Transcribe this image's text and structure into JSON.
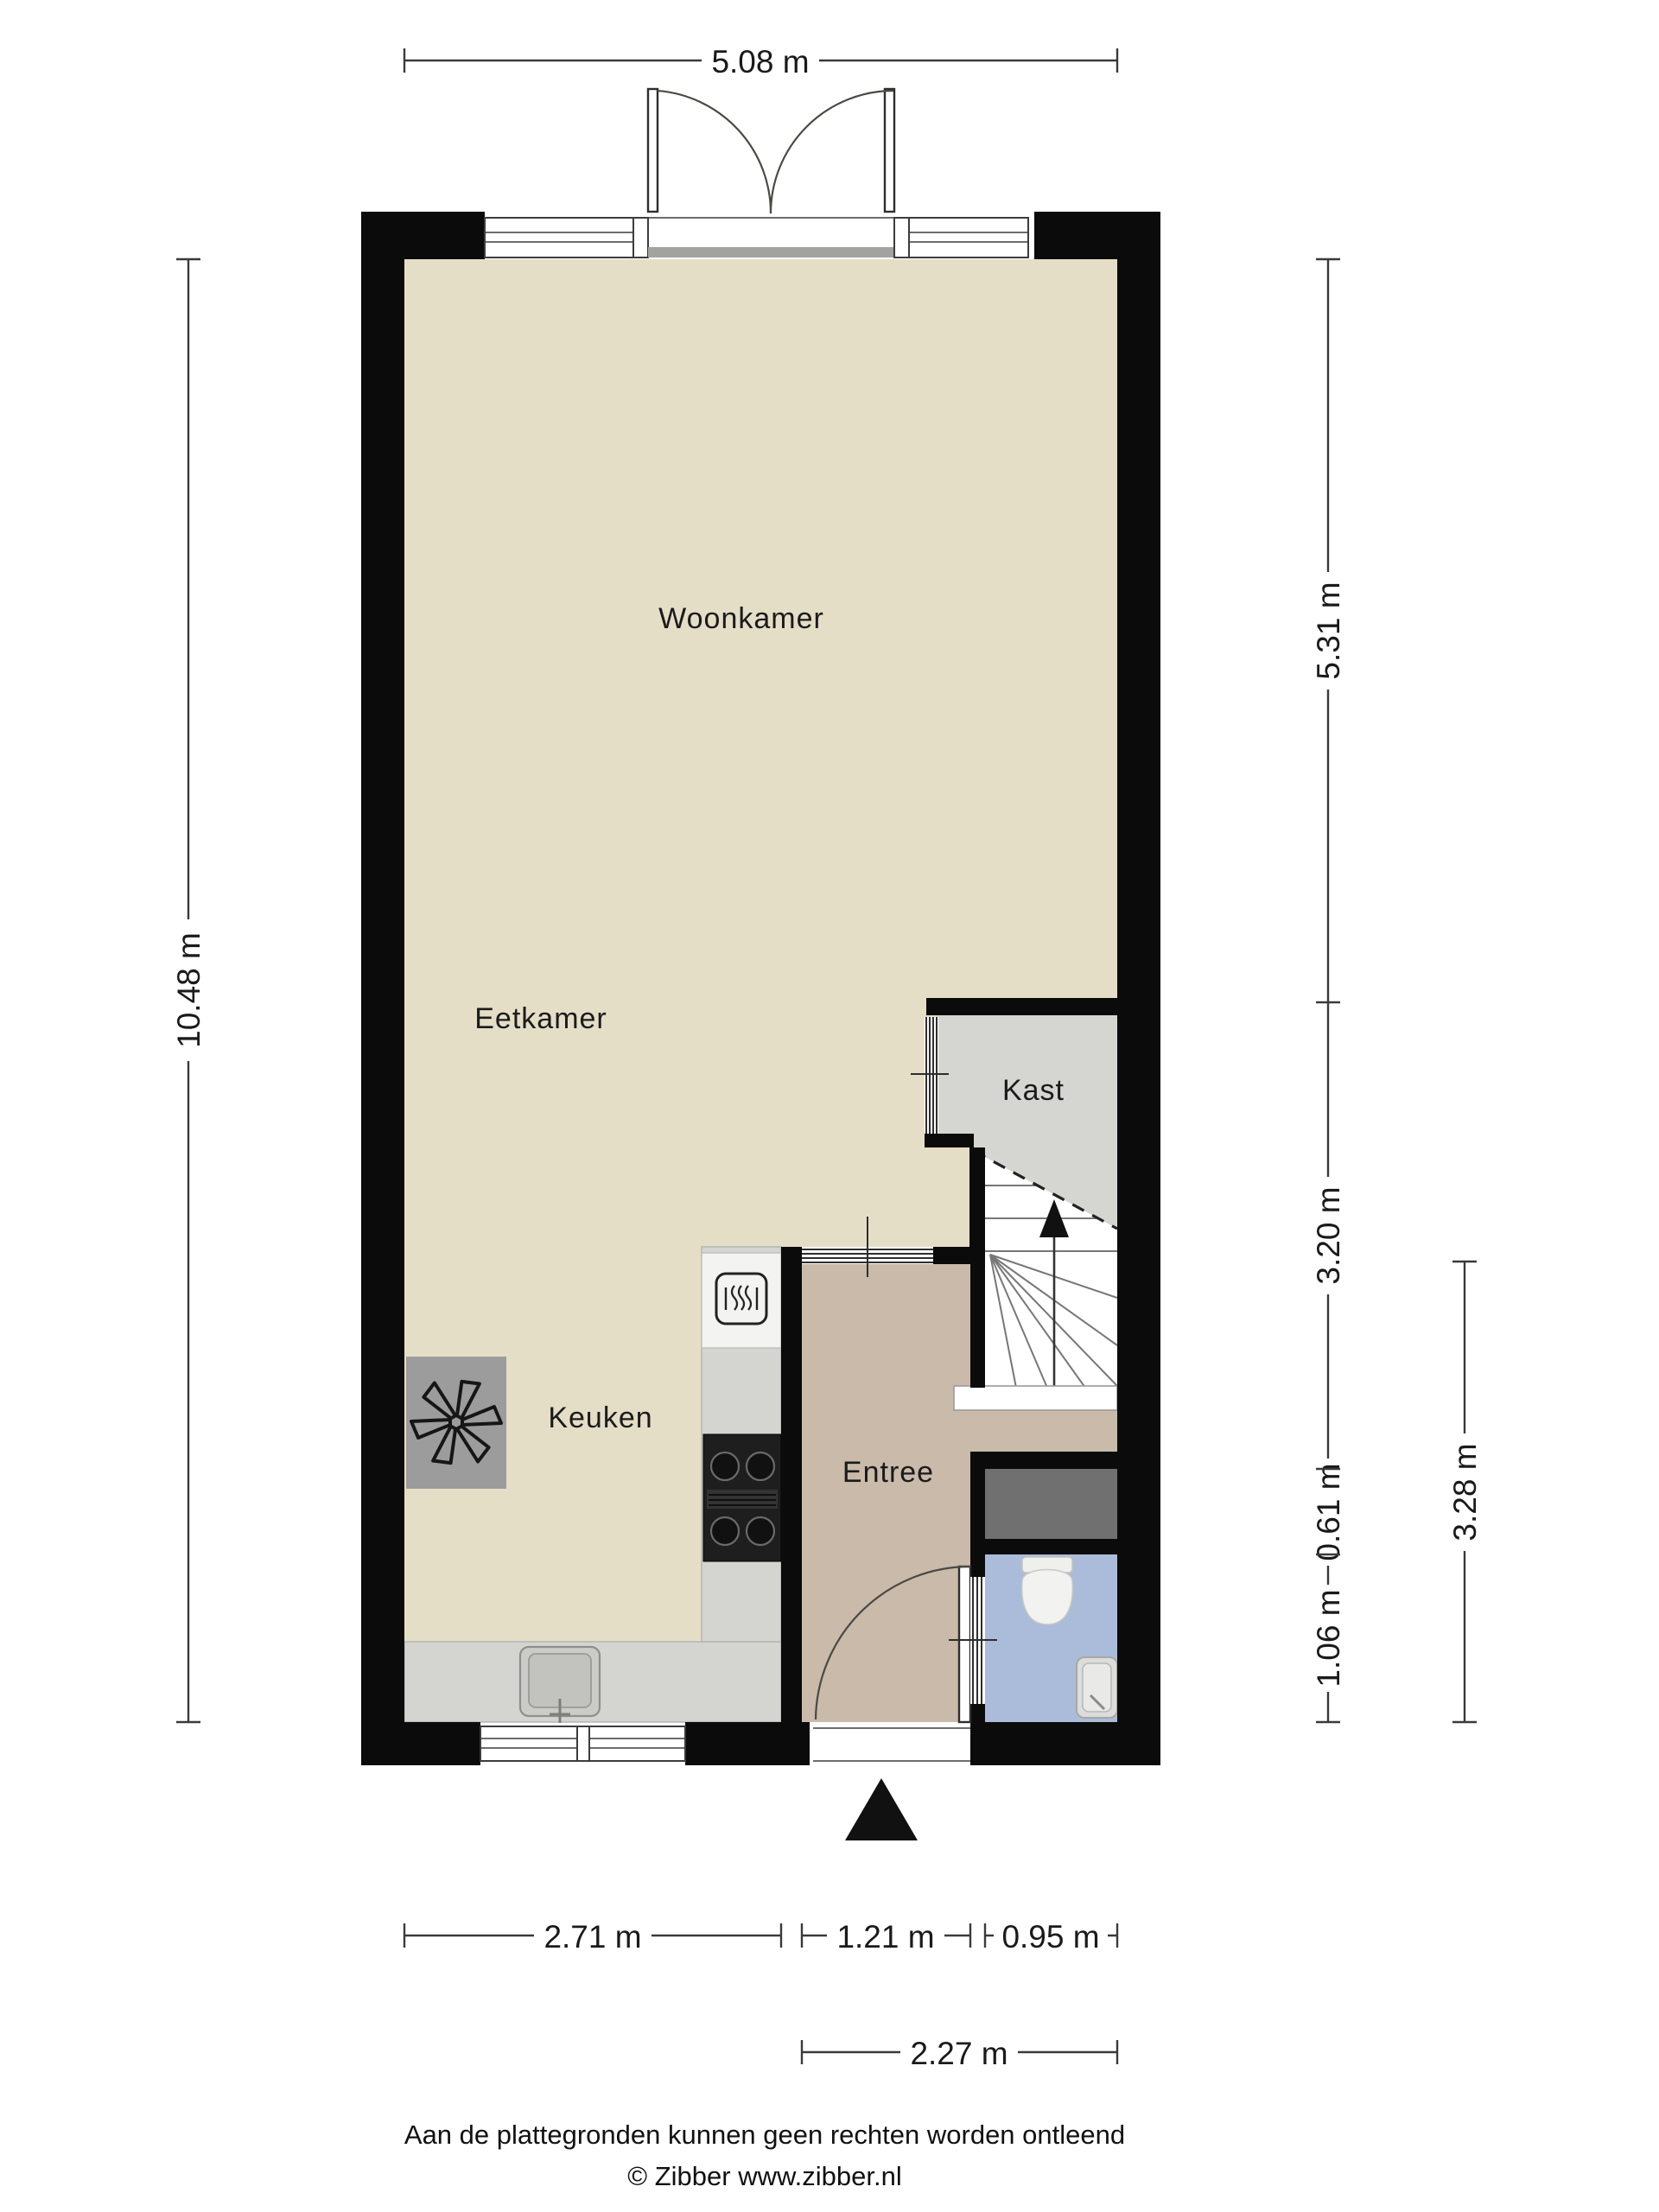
{
  "rooms": {
    "woonkamer": "Woonkamer",
    "eetkamer": "Eetkamer",
    "kast": "Kast",
    "keuken": "Keuken",
    "entree": "Entree"
  },
  "dimensions": {
    "top_width": "5.08 m",
    "left_height": "10.48 m",
    "right_living": "5.31 m",
    "right_stairs": "3.20 m",
    "right_meterkast": "0.61 m",
    "right_toilet": "1.06 m",
    "right_outer": "3.28 m",
    "bottom_kitchen": "2.71 m",
    "bottom_door": "1.21 m",
    "bottom_toilet": "0.95 m",
    "bottom_outer": "2.27 m"
  },
  "footer": {
    "disclaimer": "Aan de plattegronden kunnen geen rechten worden ontleend",
    "credit": "© Zibber www.zibber.nl"
  },
  "colors": {
    "wall": "#0b0b0b",
    "floor_main": "#e5dec7",
    "floor_entree": "#c9baa9",
    "floor_kast": "#d5d5d2",
    "floor_toilet": "#aabcd9",
    "floor_meterkast": "#707070",
    "counter": "#d4d4d1",
    "appliance": "#f3f3f1",
    "cv": "#9c9c9c",
    "stove": "#1e1e1e",
    "dimline": "#3a3a3a"
  }
}
